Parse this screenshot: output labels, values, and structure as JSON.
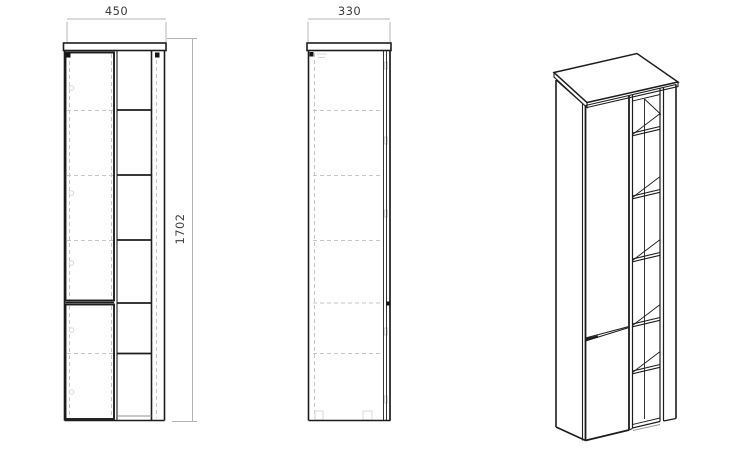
{
  "drawing": {
    "colors": {
      "line": "#1d1d1d",
      "dim_line": "#b4b4b4",
      "dim_text": "#3d3d3d",
      "hidden": "#c6c6c6",
      "faint": "#d9d9d9",
      "shadow": "#909090",
      "background": "#ffffff"
    },
    "front_view": {
      "width_label": "450",
      "height_label": "1702"
    },
    "side_view": {
      "depth_label": "330"
    }
  }
}
